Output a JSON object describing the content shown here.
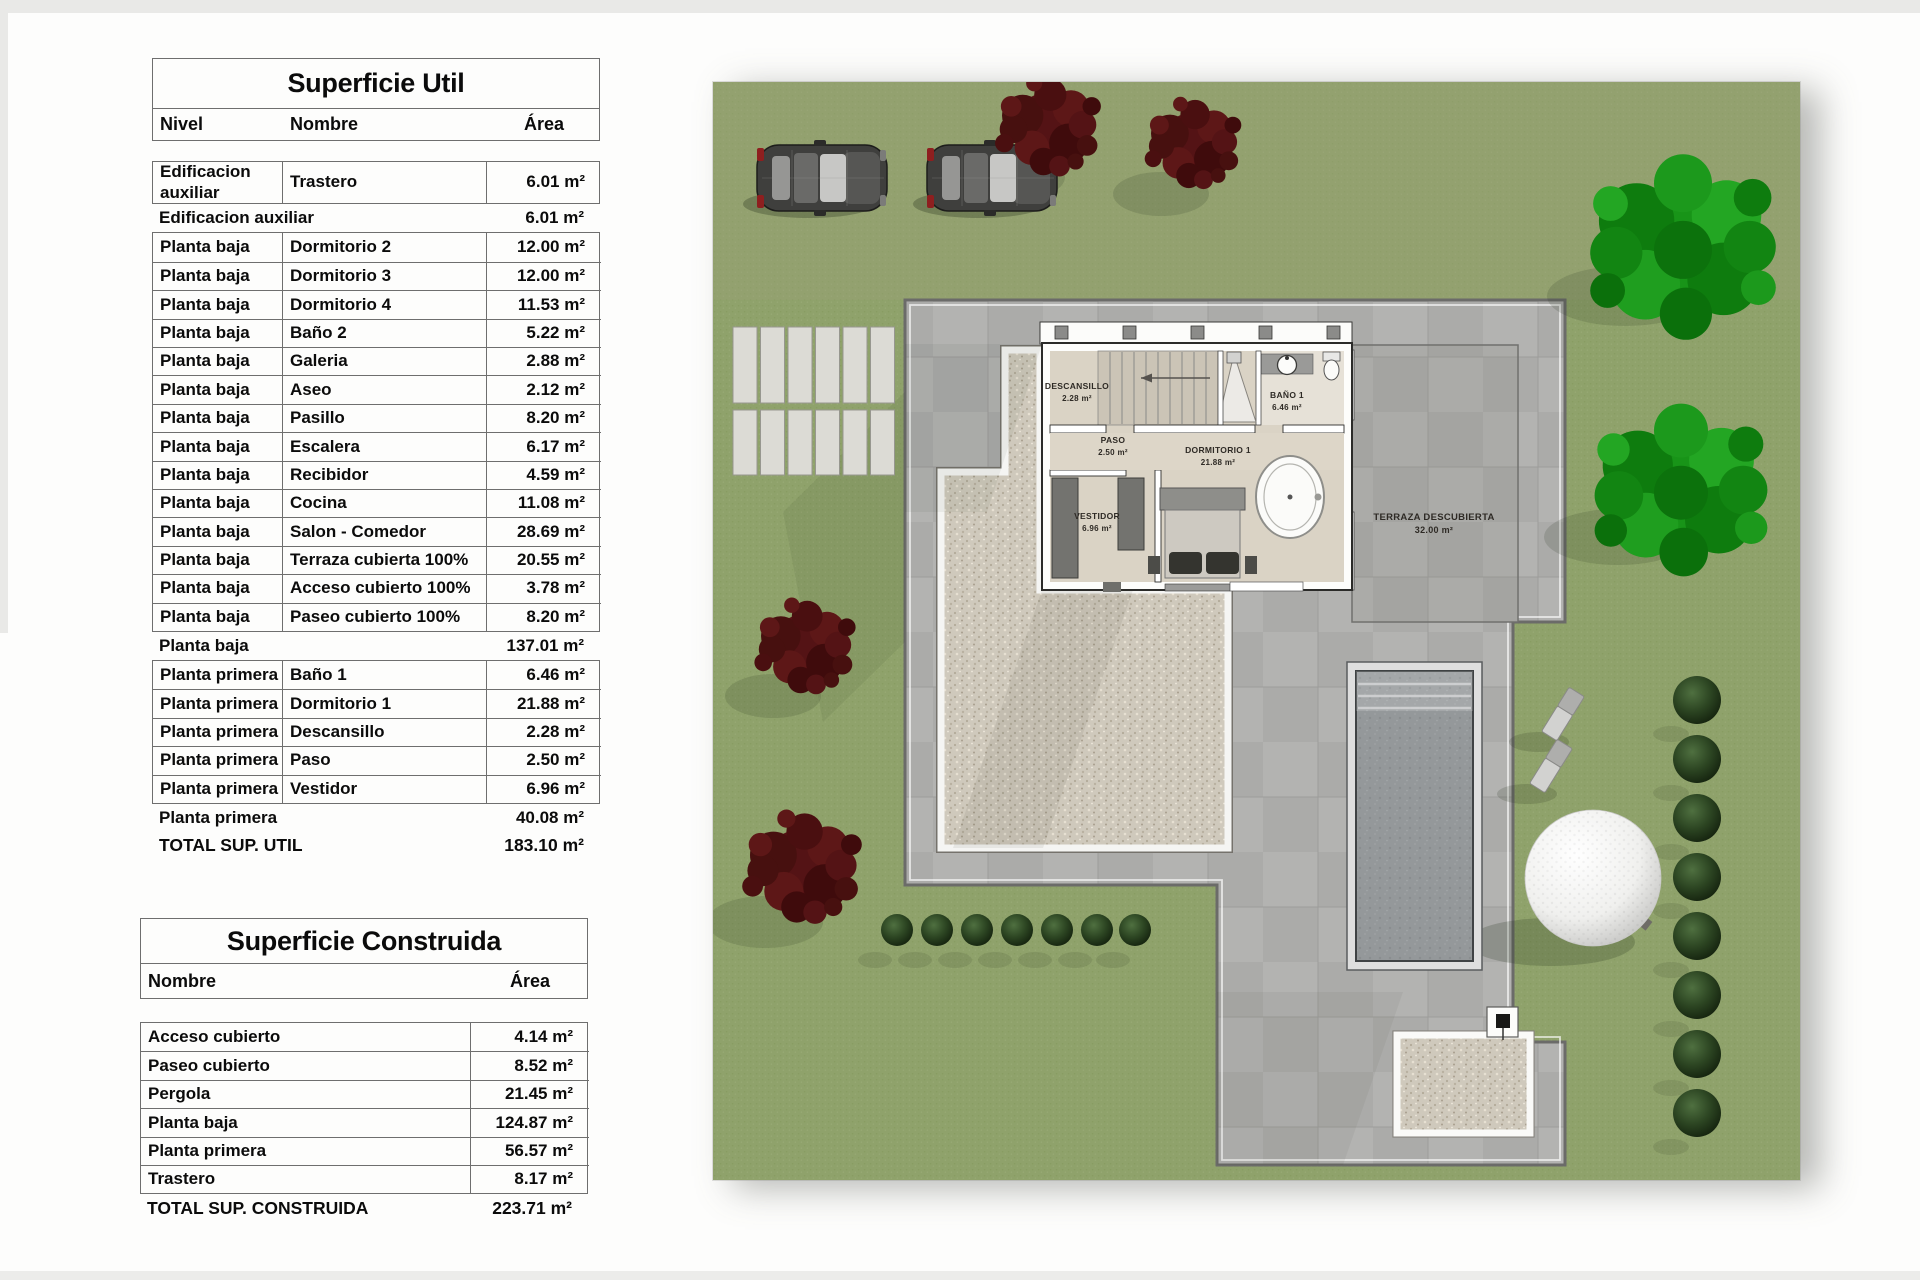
{
  "superficie_util": {
    "title": "Superficie Util",
    "columns": [
      "Nivel",
      "Nombre",
      "Área"
    ],
    "groups": [
      {
        "rows": [
          [
            "Edificacion auxiliar",
            "Trastero",
            "6.01 m²"
          ]
        ],
        "subtotal": {
          "label": "Edificacion auxiliar",
          "value": "6.01 m²"
        }
      },
      {
        "rows": [
          [
            "Planta baja",
            "Dormitorio 2",
            "12.00 m²"
          ],
          [
            "Planta baja",
            "Dormitorio 3",
            "12.00 m²"
          ],
          [
            "Planta baja",
            "Dormitorio 4",
            "11.53 m²"
          ],
          [
            "Planta baja",
            "Baño 2",
            "5.22 m²"
          ],
          [
            "Planta baja",
            "Galeria",
            "2.88 m²"
          ],
          [
            "Planta baja",
            "Aseo",
            "2.12 m²"
          ],
          [
            "Planta baja",
            "Pasillo",
            "8.20 m²"
          ],
          [
            "Planta baja",
            "Escalera",
            "6.17 m²"
          ],
          [
            "Planta baja",
            "Recibidor",
            "4.59 m²"
          ],
          [
            "Planta baja",
            "Cocina",
            "11.08 m²"
          ],
          [
            "Planta baja",
            "Salon - Comedor",
            "28.69 m²"
          ],
          [
            "Planta baja",
            "Terraza cubierta 100%",
            "20.55 m²"
          ],
          [
            "Planta baja",
            "Acceso cubierto 100%",
            "3.78 m²"
          ],
          [
            "Planta baja",
            "Paseo cubierto 100%",
            "8.20 m²"
          ]
        ],
        "subtotal": {
          "label": "Planta baja",
          "value": "137.01 m²"
        }
      },
      {
        "rows": [
          [
            "Planta primera",
            "Baño 1",
            "6.46 m²"
          ],
          [
            "Planta primera",
            "Dormitorio 1",
            "21.88 m²"
          ],
          [
            "Planta primera",
            "Descansillo",
            "2.28 m²"
          ],
          [
            "Planta primera",
            "Paso",
            "2.50 m²"
          ],
          [
            "Planta primera",
            "Vestidor",
            "6.96 m²"
          ]
        ],
        "subtotal": {
          "label": "Planta primera",
          "value": "40.08 m²"
        }
      }
    ],
    "total": {
      "label": "TOTAL SUP. UTIL",
      "value": "183.10 m²"
    }
  },
  "superficie_construida": {
    "title": "Superficie Construida",
    "columns": [
      "Nombre",
      "Área"
    ],
    "rows": [
      [
        "Acceso cubierto",
        "4.14 m²"
      ],
      [
        "Paseo cubierto",
        "8.52 m²"
      ],
      [
        "Pergola",
        "21.45 m²"
      ],
      [
        "Planta baja",
        "124.87 m²"
      ],
      [
        "Planta primera",
        "56.57 m²"
      ],
      [
        "Trastero",
        "8.17 m²"
      ]
    ],
    "total": {
      "label": "TOTAL SUP. CONSTRUIDA",
      "value": "223.71 m²"
    }
  },
  "site_plan": {
    "rooms": [
      {
        "name": "DESCANSILLO",
        "area": "2.28 m²"
      },
      {
        "name": "BAÑO 1",
        "area": "6.46 m²"
      },
      {
        "name": "PASO",
        "area": "2.50 m²"
      },
      {
        "name": "DORMITORIO 1",
        "area": "21.88 m²"
      },
      {
        "name": "VESTIDOR",
        "area": "6.96 m²"
      },
      {
        "name": "TERRAZA DESCUBIERTA",
        "area": "32.00 m²"
      }
    ],
    "colors": {
      "grass": "#8fa26b",
      "paving": "#ababa9",
      "gravel": "#cfc9bc",
      "pool_water": "#94989a",
      "bush": "#2f4626",
      "tree_red": "#541315",
      "tree_green": "#189418",
      "sphere": "#ffffff"
    }
  }
}
